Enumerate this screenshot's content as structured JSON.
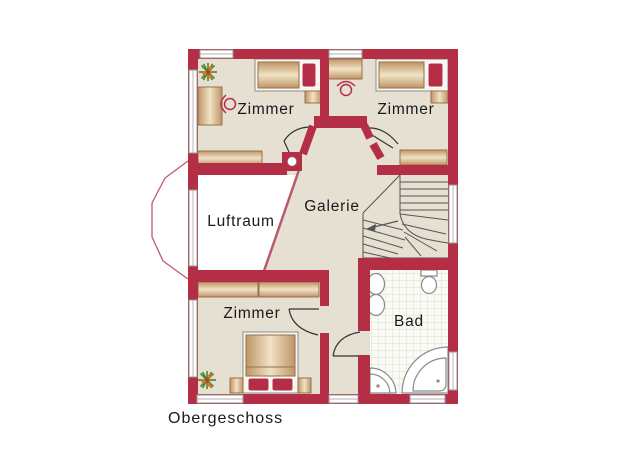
{
  "title": {
    "label": "Obergeschoss"
  },
  "rooms": {
    "zimmer_top_left": {
      "label": "Zimmer"
    },
    "zimmer_top_right": {
      "label": "Zimmer"
    },
    "zimmer_bottom": {
      "label": "Zimmer"
    },
    "luftraum": {
      "label": "Luftraum"
    },
    "galerie": {
      "label": "Galerie"
    },
    "bad": {
      "label": "Bad"
    }
  },
  "colors": {
    "wall": "#b42e45",
    "floor": "#e5e0d2",
    "void": "#ffffff",
    "tile_bg": "#fbfbf6",
    "tile_line": "#dedcd0",
    "wood_edge": "#bf9466",
    "wood_mid": "#f0e3c6",
    "wood_border": "#96714a",
    "mattress": "#f7f5ee",
    "pillow": "#b42e45",
    "fixture_fill": "#ffffff",
    "fixture_stroke": "#8a8a8a",
    "plant_green": "#4e8230",
    "plant_berry": "#e2731f",
    "door_stroke": "#333333",
    "stair_stroke": "#555555",
    "window_frame": "#999999",
    "railing": "#bc5a6d",
    "text": "#1a1a1a"
  }
}
